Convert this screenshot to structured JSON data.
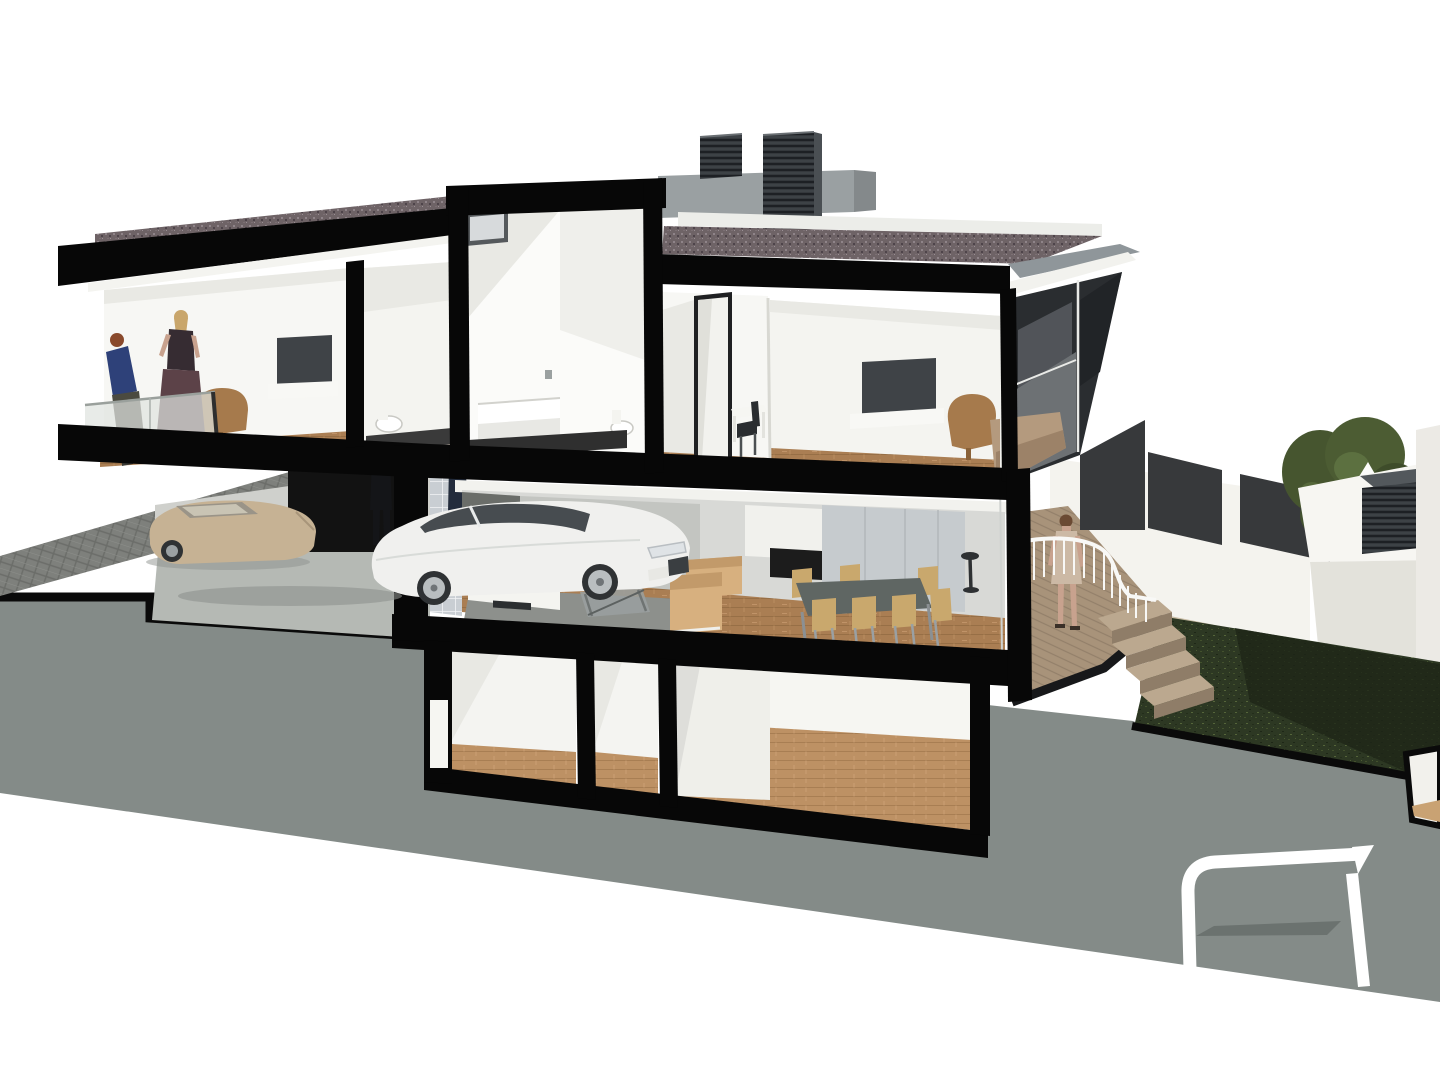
{
  "colors": {
    "sky": "#ffffff",
    "earth": "#848b88",
    "poche": "#070707",
    "cutline": "#0a0a0a",
    "apron": "#b5b9b4",
    "carportWall": "#cfd0cc",
    "doorway": "#121212",
    "parapet": "#9aa0a2",
    "parapetEnd": "#84898b",
    "parapetRear": "#eCeDe9",
    "fasciaGray": "#8f969a",
    "soffit": "#f2f2ee",
    "wallWhite": "#f7f7f4",
    "wallLight": "#f4f4f0",
    "wallShade": "#e9e9e4",
    "wallShade2": "#d8d9d6",
    "wallDark": "#6a6d69",
    "wallMid": "#c3c5c1",
    "cabinet": "#c6cbce",
    "interiorCeil": "#fbfbf9",
    "tileDark": "#2f2f2f",
    "bathFloor": "#3a3a3a",
    "skylightFrame": "#55595c",
    "skylightGlass": "#d7dadc",
    "tv": "#3f4347",
    "shelfWhite": "#f8f8f5",
    "armchair": "#a67a4c",
    "sofa": "#d7b07f",
    "chairWood": "#c9a86d",
    "chrome": "#9aa0a3",
    "tableTop": "#5f6663",
    "rug": "#8d908c",
    "glassBalustrade": "#dfe3df",
    "frameDark": "#2e2e2e",
    "mullionWhite": "#f0f0ec",
    "facadeGlass": "#2a2d30",
    "facadeReflect": "#6d7174",
    "planter": "#b49a7e",
    "deckDark": "#17181a",
    "stairLight": "#bba88f",
    "stairDark": "#8f7d68",
    "railWhite": "#f8f8f6",
    "gardenWall": "#f4f3ee",
    "gardenWallShade": "#e2e1da",
    "panelDark": "#37393b",
    "baseStrip": "#c9bda6",
    "ventTop": "#53585c",
    "neighborRoof": "#f7f6f2",
    "neighborFace": "#e3e2db",
    "farWall": "#eceae5",
    "carWhite": "#f0f0ee",
    "carWindow": "#474c50",
    "carBeige": "#c6b294",
    "beigeCanopy": "#9a9488",
    "tyre": "#2f3234",
    "alloy": "#b9bec0",
    "headlight": "#dfe3e6",
    "grille": "#3a3e41",
    "shadow": "#8e918d",
    "skin": "#c8a28e",
    "hairRed": "#8a4a2c",
    "hairBlonde": "#c9a66b",
    "hairBrown": "#6b4a33",
    "woman1Top": "#2e4179",
    "woman1Skirt": "#4b4a40",
    "woman2Top": "#362c32",
    "woman2Skirt": "#5c4248",
    "deckDress": "#ccb9a5",
    "legDark": "#3a3a35",
    "figureA": "#141518",
    "figureB": "#232c3c",
    "logoWhite": "#ffffff",
    "logoGray": "#6b726f",
    "stoolDark": "#2e3133"
  }
}
